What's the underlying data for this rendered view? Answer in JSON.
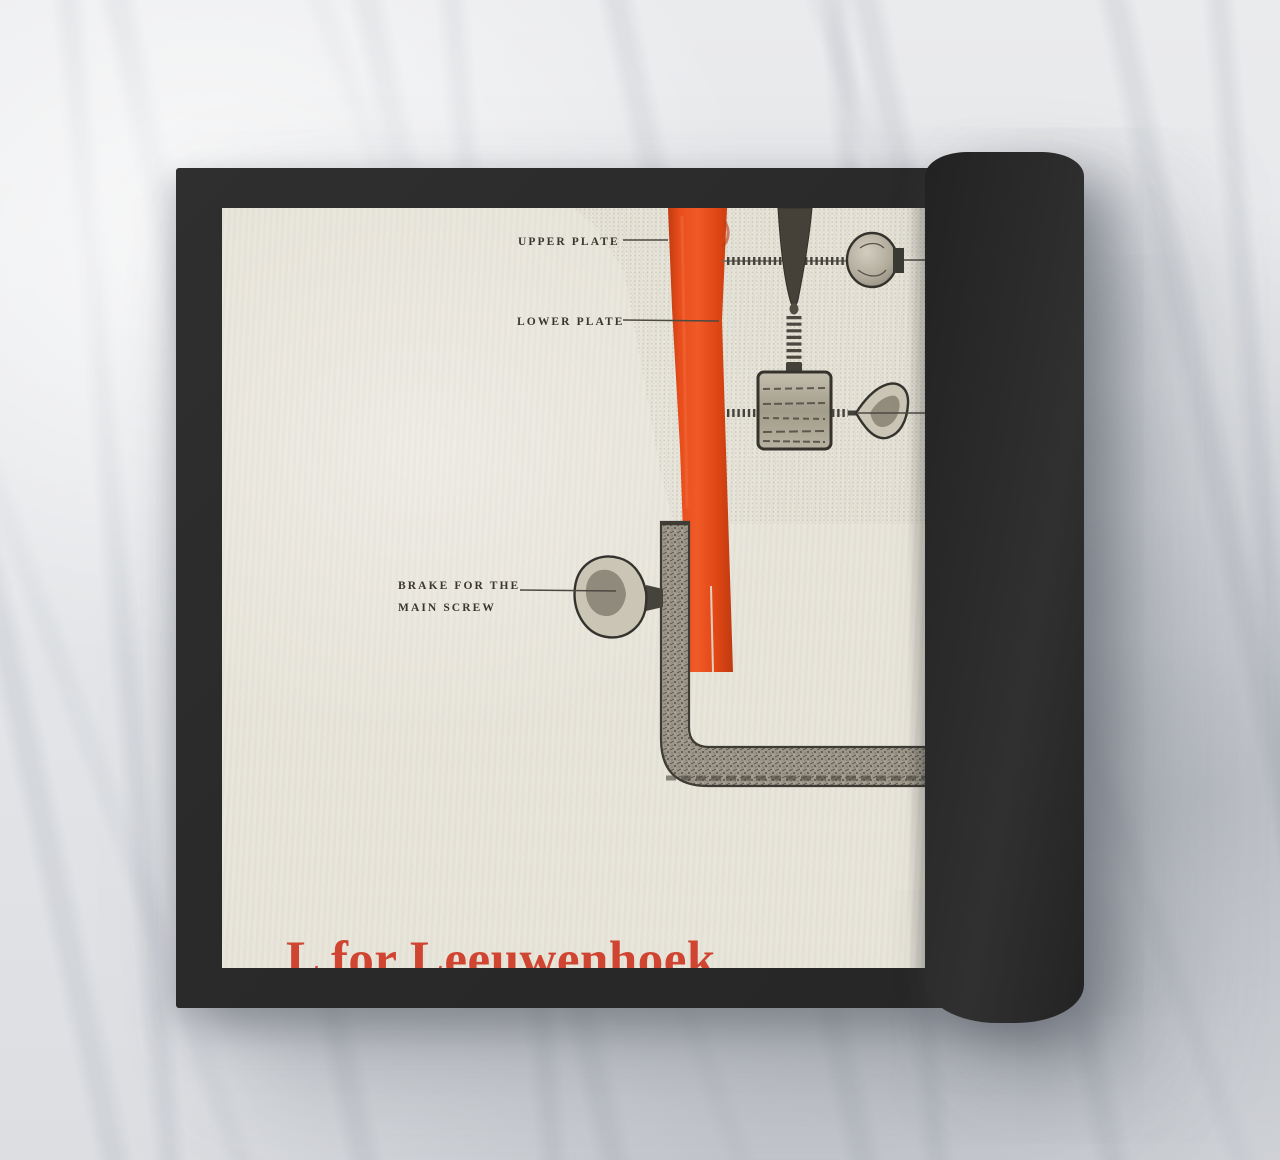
{
  "page": {
    "title": "L for Leeuwenhoek",
    "labels": {
      "upper_plate": "UPPER PLATE",
      "lower_plate": "LOWER PLATE",
      "brake_line1": "BRAKE FOR THE",
      "brake_line2": "MAIN SCREW"
    }
  },
  "colors": {
    "book_cover": "#2b2b2b",
    "paper": "#e7e4d9",
    "highlight_red": "#e04a1a",
    "title_red": "#cf4531",
    "ink": "#3a3731",
    "marble_background": "#e8eaec"
  }
}
